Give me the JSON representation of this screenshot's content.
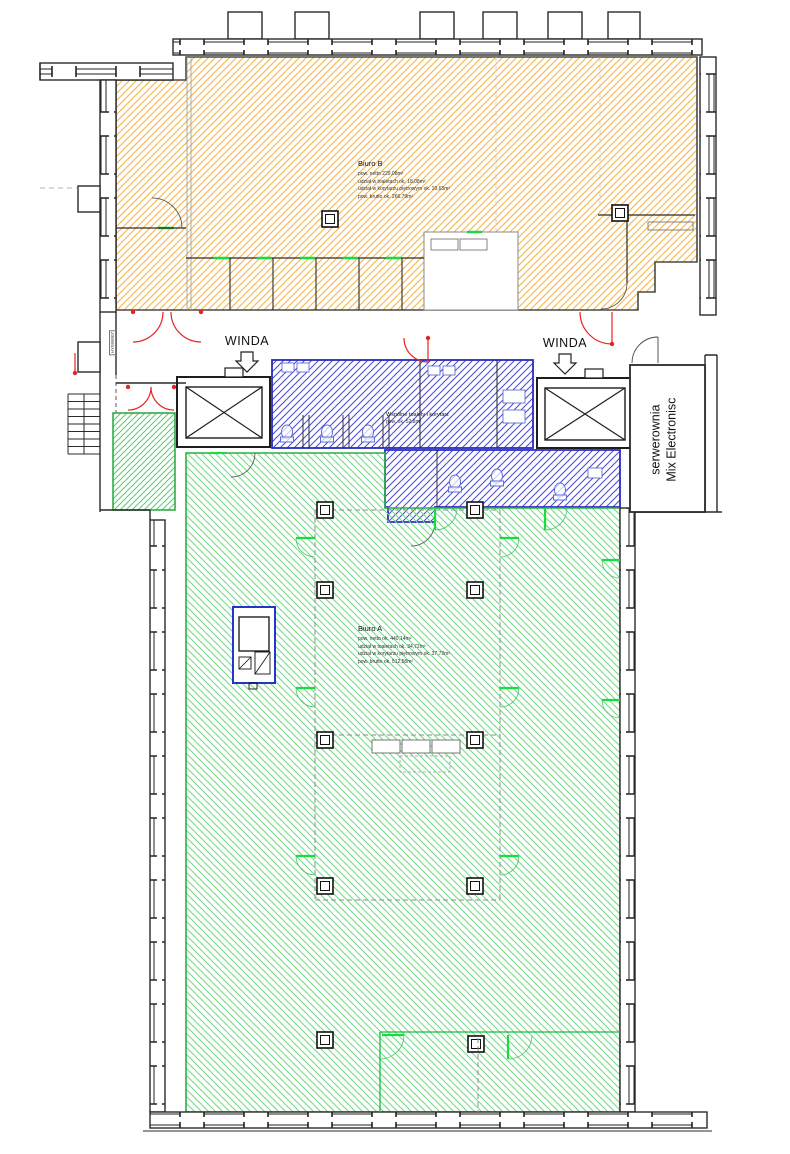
{
  "plan": {
    "winda1": "WINDA",
    "winda2": "WINDA",
    "server_room": {
      "line1": "serwerownia",
      "line2": "Mix Electronisc"
    },
    "biuro_b": {
      "title": "Biuro B",
      "line1": "pow. netto 229,08m²",
      "line2": "udział w toaletach ok. 18,08m²",
      "line3": "udział w korytarzu piętrowym ok. 19,63m²",
      "line4": "pow. brutto ok. 266,79m²"
    },
    "biuro_a": {
      "title": "Biuro A",
      "line1": "pow. netto ok. 440,14m²",
      "line2": "udział w toaletach ok. 34,72m²",
      "line3": "udział w korytarzu piętrowym ok. 37,72m²",
      "line4": "pow. brutto ok. 512,58m²"
    },
    "shared": {
      "line1": "Wspólne toalety i korytarz",
      "line2": "pow. ok. 52,8m²"
    },
    "wall_tag": "HY099007",
    "colors": {
      "office_b_hatch": "#f3b23e",
      "office_a_hatch": "#6fdb84",
      "shared_hatch": "#4747d8",
      "door_red": "#e82222",
      "door_green": "#17de3c",
      "wall": "#2a2a2a"
    }
  }
}
